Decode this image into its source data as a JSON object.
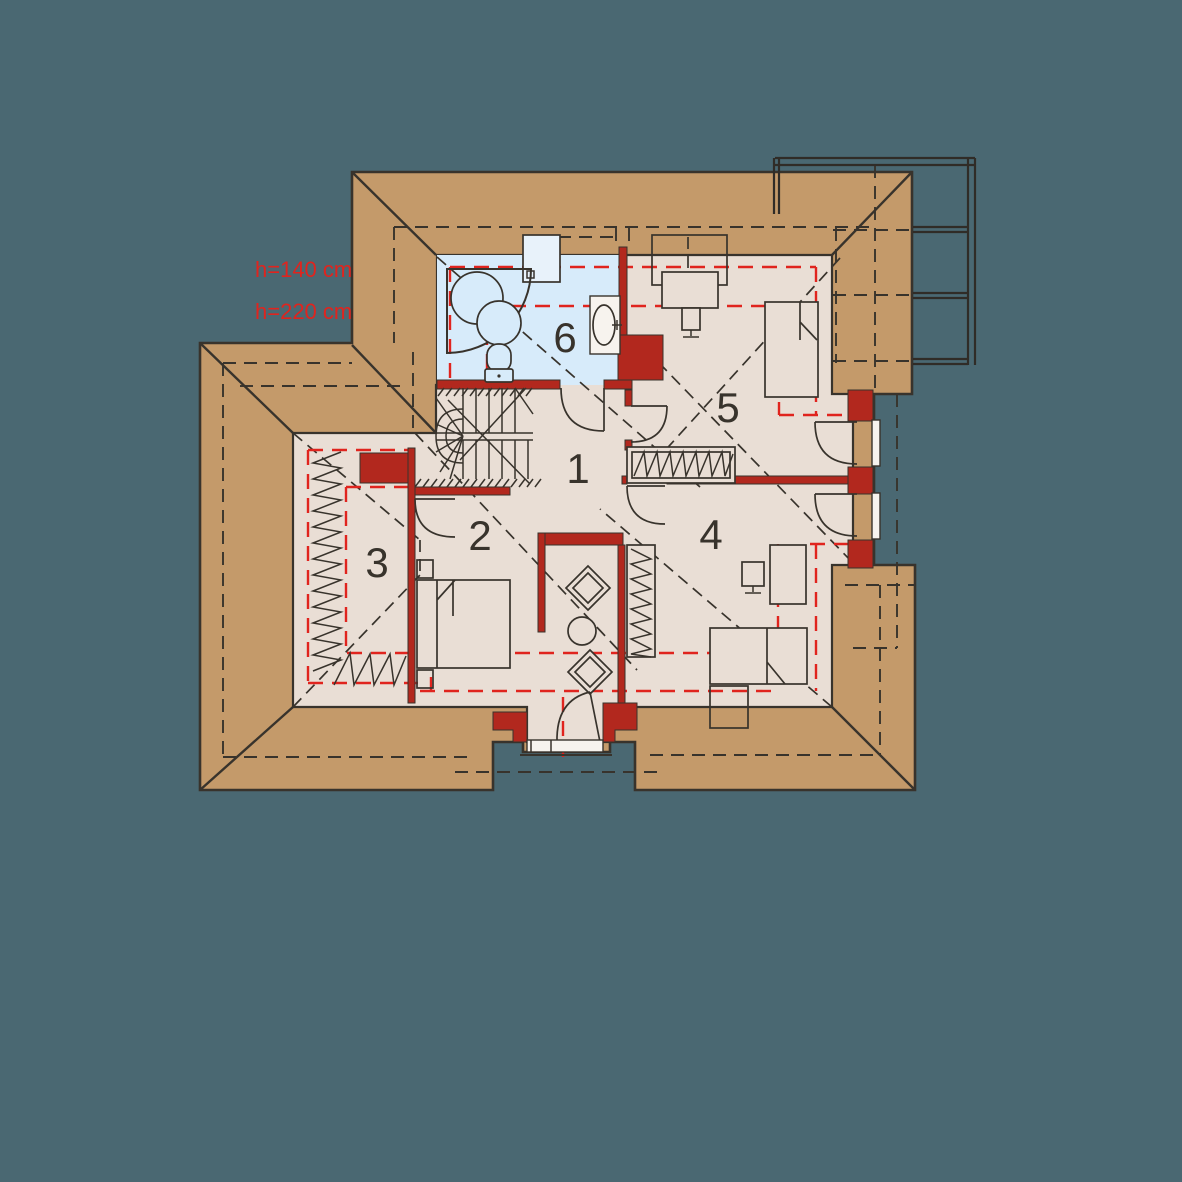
{
  "plan": {
    "type": "attic floor plan"
  },
  "annotations": {
    "height1": "h=140 cm",
    "height2": "h=220 cm"
  },
  "rooms": [
    {
      "number": "1"
    },
    {
      "number": "2"
    },
    {
      "number": "3"
    },
    {
      "number": "4"
    },
    {
      "number": "5"
    },
    {
      "number": "6"
    }
  ],
  "colors": {
    "background": "#4A6872",
    "roof": "#C49A6A",
    "floor": "#E9DED5",
    "bathroom_floor": "#D7EBFA",
    "wall": "#B2281E",
    "height_line": "#E0241E",
    "line": "#38332C",
    "railing": "#302C27",
    "chimney": "#E8F2FA",
    "sill": "#F7F3EE"
  }
}
